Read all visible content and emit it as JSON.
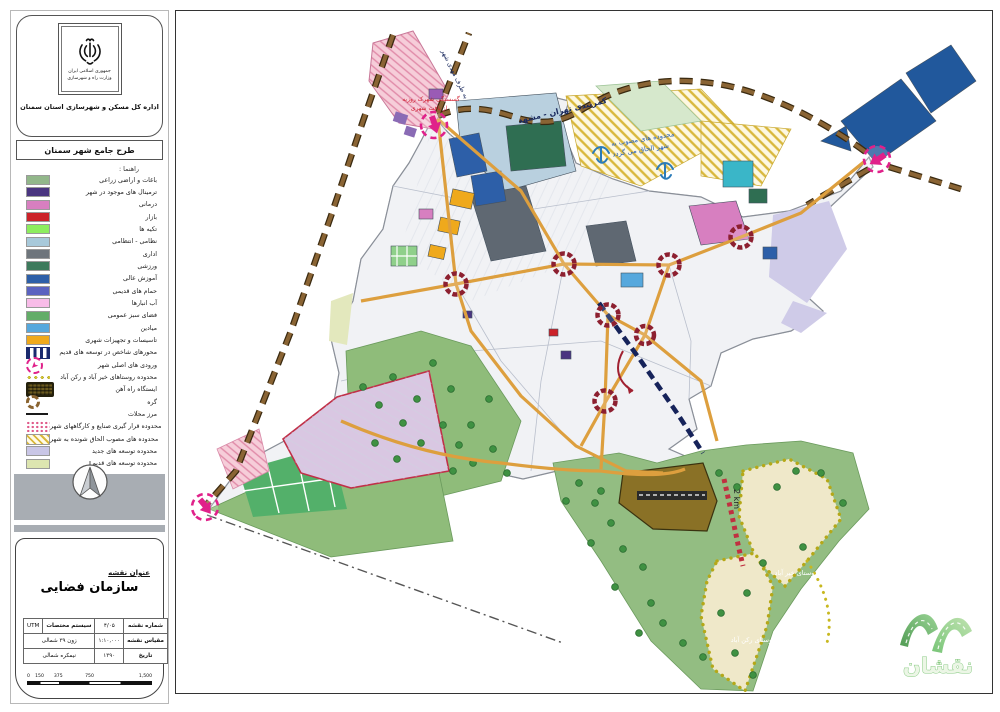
{
  "sidebar": {
    "country": "جمهوری اسلامی ایران",
    "ministry": "وزارت راه و شهرسازی",
    "office": "اداره کل مسکن و شهرسازی استان سمنان",
    "plan_title": "طرح جامع شهر سمنان",
    "legend_heading": "راهنما :",
    "legend_items": [
      {
        "label": "باغات و اراضی زراعی",
        "type": "rect",
        "color": "#92b78a"
      },
      {
        "label": "ترمینال های موجود در شهر",
        "type": "rect",
        "color": "#4a3580"
      },
      {
        "label": "درمانی",
        "type": "rect",
        "color": "#d77fc0"
      },
      {
        "label": "بازار",
        "type": "rect",
        "color": "#cc2229"
      },
      {
        "label": "تکیه ها",
        "type": "rect",
        "color": "#8ded5e"
      },
      {
        "label": "نظامی - انتظامی",
        "type": "rect",
        "color": "#a8c9da"
      },
      {
        "label": "اداری",
        "type": "rect",
        "color": "#6e757c"
      },
      {
        "label": "ورزشی",
        "type": "rect",
        "color": "#3d7a5c"
      },
      {
        "label": "آموزش عالی",
        "type": "rect",
        "color": "#2d5fa8"
      },
      {
        "label": "حمام های قدیمی",
        "type": "rect",
        "color": "#5b63c0"
      },
      {
        "label": "آب انبارها",
        "type": "rect",
        "color": "#f8bce8"
      },
      {
        "label": "فضای سبز عمومی",
        "type": "rect",
        "color": "#63ad68"
      },
      {
        "label": "میادین",
        "type": "rect",
        "color": "#56a8dd"
      },
      {
        "label": "تاسیسات و تجهیزات شهری",
        "type": "rect",
        "color": "#efa91c"
      },
      {
        "label": "محورهای شاخص در توسعه های قدیم",
        "type": "bars",
        "color": "#1a2a6e"
      },
      {
        "label": "ورودی های اصلی شهر",
        "type": "entrance",
        "color": "#e0218a"
      },
      {
        "label": "محدوده روستاهای خیر آباد و رکن آباد",
        "type": "dots-line",
        "color": "#d8c62e"
      },
      {
        "label": "ایستگاه راه آهن",
        "type": "railway",
        "color": "#6b5a1e"
      },
      {
        "label": "گره",
        "type": "node-ring",
        "color": "#8a6430"
      },
      {
        "label": "مرز محلات",
        "type": "line",
        "color": "#1a1a1a"
      },
      {
        "label": "محدوده قرار گیری صنایع و کارگاههای شهر",
        "type": "pink-dots",
        "color": "#e05a8a"
      },
      {
        "label": "محدوده های مصوب الحاق شونده به شهر",
        "type": "yellow-hatch",
        "color": "#d9b83c"
      },
      {
        "label": "محدوده توسعه های جدید",
        "type": "rect",
        "color": "#c9c6e6"
      },
      {
        "label": "محدوده توسعه های قدیم",
        "type": "rect",
        "color": "#dde5b0"
      }
    ]
  },
  "title_block": {
    "heading": "عنوان نقشه",
    "map_title": "سازمان فضایی",
    "fields": {
      "map_no_label": "شماره نقشه",
      "map_no": "۴/۰۵",
      "coord_label": "سیستم مختصات",
      "coord_value": "UTM",
      "scale_label": "مقیاس نقشه",
      "scale_value": "۱:۱۰,۰۰۰",
      "zone_value": "زون ۳۹ شمالی",
      "date_label": "تاریخ",
      "date_value": "۱۳۹۰",
      "hemisphere_value": "نیمکره شمالی"
    },
    "scalebar": {
      "ticks": [
        "0",
        "150",
        "375",
        "750",
        "1,500"
      ]
    }
  },
  "map": {
    "labels": {
      "to_mahdishahr": "به طرف مهدی شهر",
      "beltway": "کمربندی تهران - مشهد",
      "note_red_1": "گسستگی شهرک روزیه",
      "note_red_2": "از بافت شهری",
      "note_blue_1": "محدوده های مصوب به",
      "note_blue_2": "شهر الحاق می گردد",
      "distance": "2 km",
      "village_kheyrabad": "روستای خیر آباد",
      "village_roknabad": "روستای رکن آباد"
    },
    "watermark": "نقشان",
    "colors": {
      "ring_road": "#7a5230",
      "main_road": "#dd9f3e",
      "node": "#8d2030",
      "entrance": "#e0218a",
      "index_axis": "#16235a",
      "green_space": "#8fbc7a",
      "new_development": "#d9c7e2",
      "village_fill": "#efe8c9",
      "university_blue": "#21589c",
      "station_brown": "#8a7126"
    }
  }
}
